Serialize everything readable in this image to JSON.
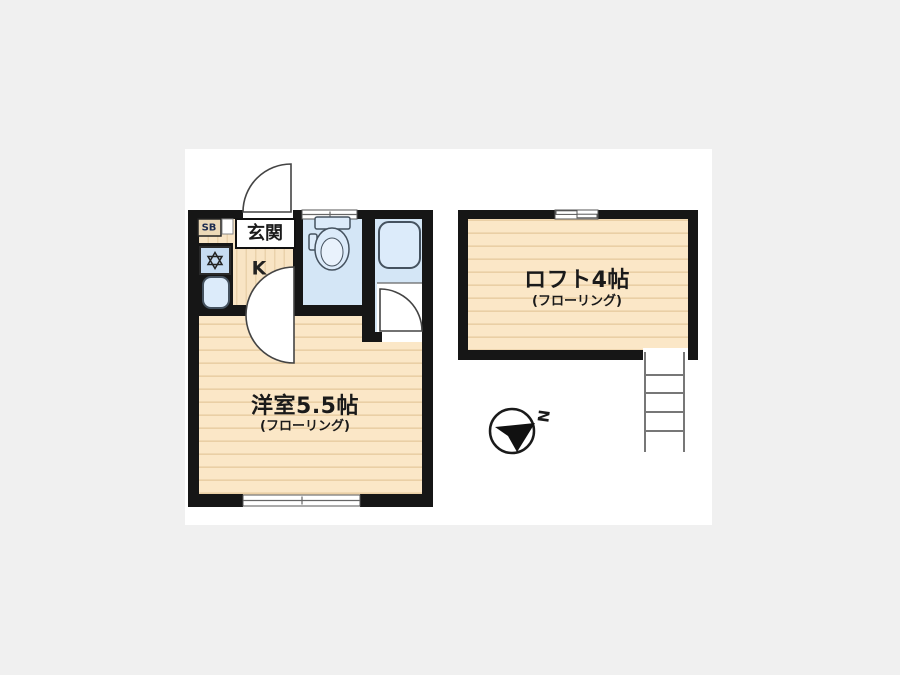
{
  "colors": {
    "page_bg": "#f0f0f0",
    "canvas_bg": "#ffffff",
    "wall": "#161616",
    "floor_base": "#fbe7c7",
    "floor_stripe": "#eacfa5",
    "entry_base": "#f8e4c4",
    "entry_stripe": "#ead2ab",
    "room_blue": "#d4e6f6",
    "appliance_blue": "#c6dcf2",
    "fixture_blue": "#dcebfa",
    "fixture_stroke": "#45525f",
    "door_stroke": "#444444",
    "ladder": "#777777",
    "text": "#1a1a1a",
    "sb_bg": "#ecd9b8",
    "sb_text": "#1c2b50"
  },
  "plan": {
    "entrance_label": "玄関",
    "kitchen_label": "K",
    "shoe_box_label": "SB",
    "main_room_label": "洋室5.5帖",
    "main_room_sub": "(フローリング)",
    "loft_label": "ロフト4帖",
    "loft_sub": "(フローリング)",
    "compass_north_label": "N"
  }
}
